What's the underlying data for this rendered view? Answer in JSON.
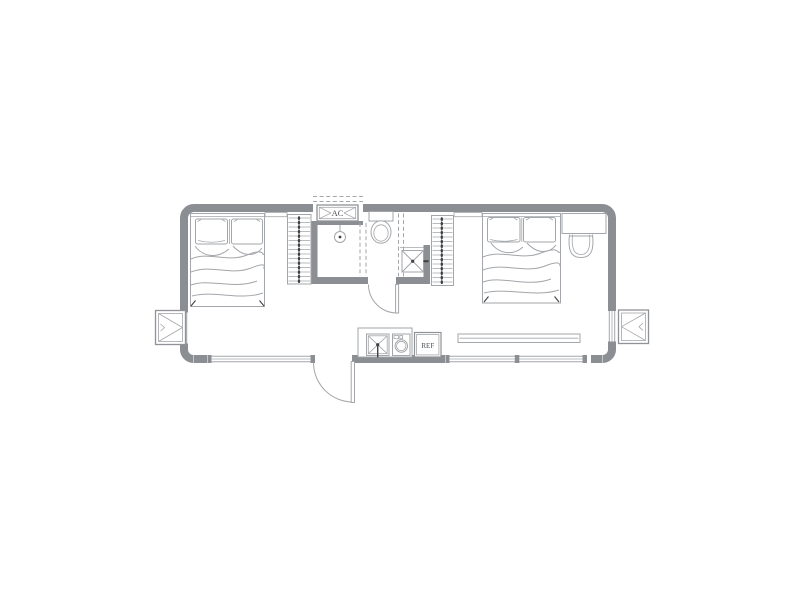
{
  "plan": {
    "type": "studio-apartment-floor-plan",
    "labels": {
      "ac_unit": "AC",
      "refrigerator": "REF"
    },
    "colors": {
      "background": "#ffffff",
      "wall": "#8b8e92",
      "line_light": "#a3a6aa",
      "line_medium": "#8f9296",
      "accent_dark": "#3e4042",
      "label_text": "#4b4d50"
    },
    "fixtures": [
      "double-bed-left",
      "double-bed-right",
      "wardrobe-left",
      "wardrobe-right",
      "shower",
      "toilet",
      "washbasin",
      "ac-unit",
      "kitchen-sink",
      "washing-machine",
      "refrigerator",
      "tv-bench",
      "desk",
      "chair",
      "entry-door",
      "bathroom-door",
      "window-bottom-left",
      "window-bottom-right",
      "window-side-left",
      "window-side-right",
      "ac-platform-left",
      "ac-platform-right"
    ]
  }
}
